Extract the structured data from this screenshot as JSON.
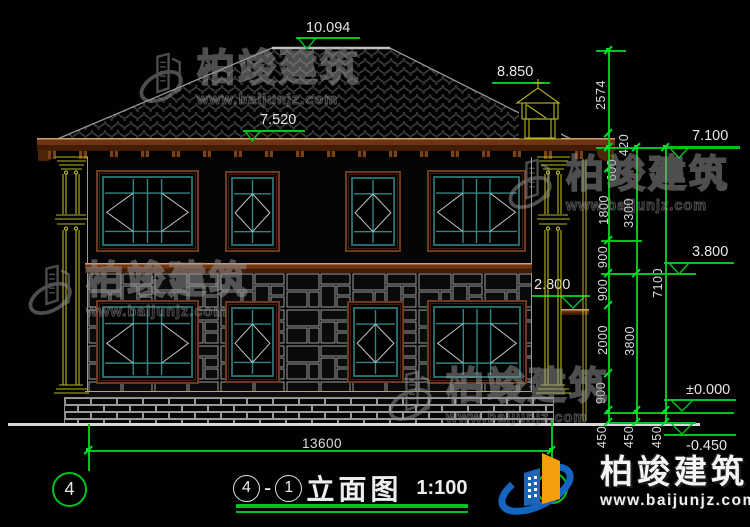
{
  "levels": {
    "ridge": "10.094",
    "chimney": "8.850",
    "eave_top": "7.520",
    "eave": "7.100",
    "floor2": "3.800",
    "canopy": "2.800",
    "zero": "±0.000",
    "site": "-0.450"
  },
  "dims": {
    "total_width": "13600",
    "chain_inner": [
      "2574",
      "420",
      "600",
      "1800",
      "900",
      "900",
      "2000",
      "900",
      "450"
    ],
    "chain_mid": [
      "3300",
      "3800",
      "450"
    ],
    "chain_outer": [
      "7100",
      "450"
    ]
  },
  "axes": {
    "left": "4"
  },
  "title": {
    "left_axis": "4",
    "dash": "-",
    "right_axis": "1",
    "name": "立面图",
    "scale": "1:100"
  },
  "watermark": {
    "name": "柏竣建筑",
    "site": "www.baijunjz.com"
  },
  "brand": {
    "name": "柏竣建筑",
    "site": "www.baijunjz.com"
  },
  "colors": {
    "dimension_green": "#00c41e",
    "cad_yellow": "#b8b81e",
    "frame_brown": "#70391a",
    "frame_teal": "#2f8585",
    "brand_blue": "#1565c0",
    "brand_orange": "#f59d0a"
  }
}
